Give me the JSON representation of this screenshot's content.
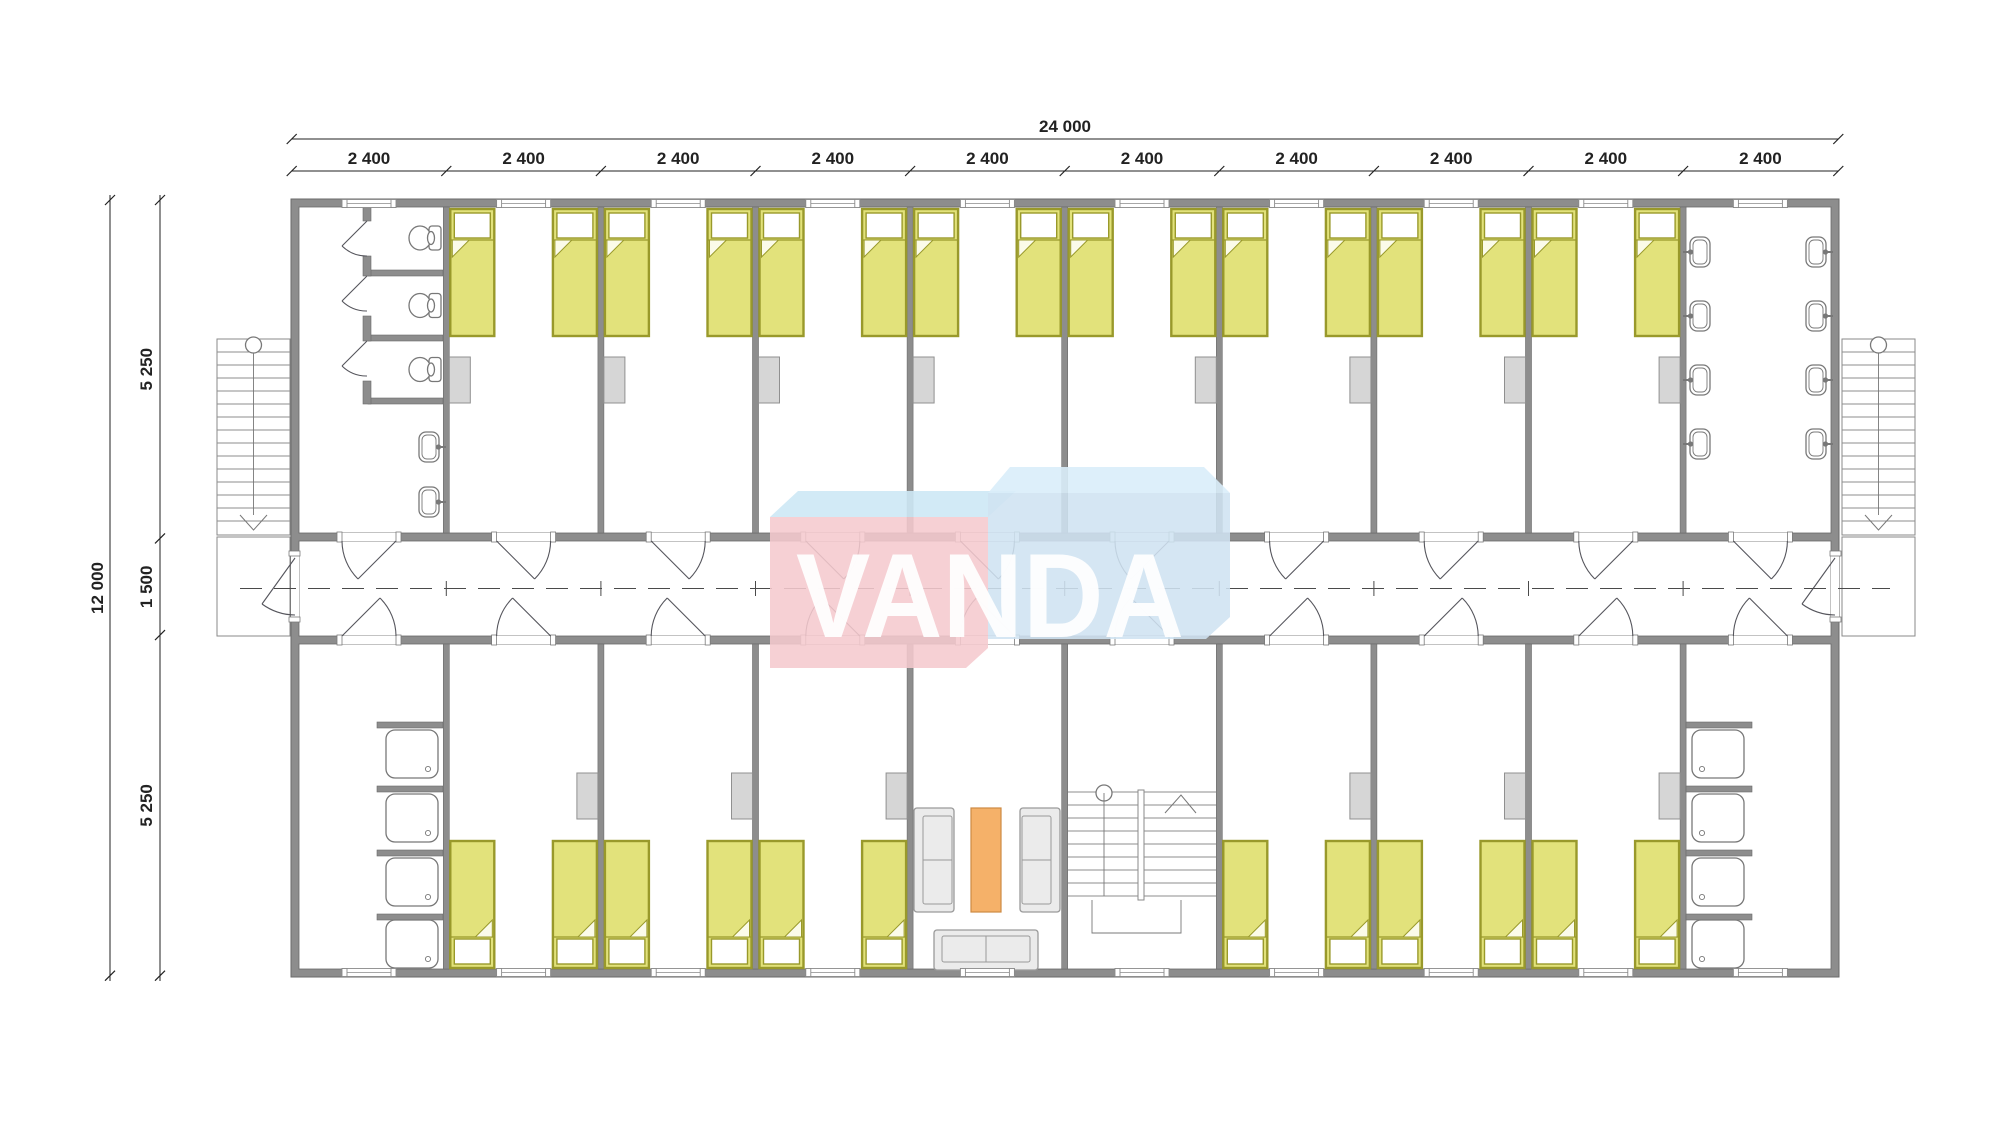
{
  "watermark": {
    "text": "VANDA"
  },
  "dimensions": {
    "top_total": "24 000",
    "top_segments": [
      "2 400",
      "2 400",
      "2 400",
      "2 400",
      "2 400",
      "2 400",
      "2 400",
      "2 400",
      "2 400",
      "2 400"
    ],
    "left_total": "12 000",
    "left_segments": [
      "5 250",
      "1 500",
      "5 250"
    ]
  },
  "colors": {
    "wall": "#8d8d8d",
    "wall_edge": "#6a6a6a",
    "bed_fill": "#e2e27b",
    "bed_border": "#99992b",
    "pillow": "#ffffff",
    "fold": "#fbfbe9",
    "wardrobe": "#d6d6d6",
    "wardrobe_edge": "#909090",
    "sofa": "#ebebeb",
    "sofa_edge": "#9a9a9a",
    "table": "#f5b169",
    "table_edge": "#cd8a43",
    "fixture": "#787878",
    "dimension": "#222222",
    "centerline": "#4a4a4a",
    "watermark_pink": "#f5c9ce",
    "watermark_blue": "#cfe2f1",
    "watermark_top_left": "#cde8f5",
    "watermark_top_right": "#d9edfa",
    "watermark_text": "#ffffff"
  },
  "inventory": {
    "modules": 10,
    "bedrooms": 14,
    "beds": 28,
    "wc_stalls": 3,
    "wall_basins": 10,
    "showers": 8,
    "sofas": 3,
    "coffee_tables": 1,
    "internal_staircases": 1,
    "external_staircases": 2
  }
}
